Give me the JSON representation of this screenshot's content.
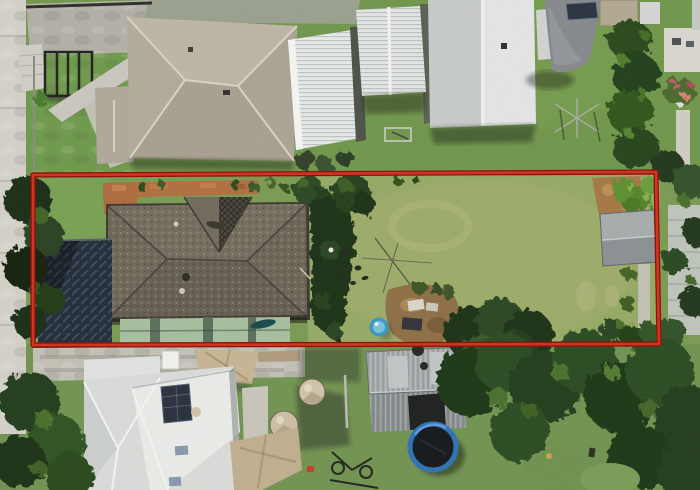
{
  "scene": {
    "kind": "aerial-drone-photograph",
    "subject": "residential lot outlined with red property boundary",
    "boundary": {
      "color_core": "#d03422",
      "color_edge": "#8a140b",
      "points": "33,175 656,172 659,344 33,345"
    }
  },
  "palette": {
    "grass_base": "#7a9a52",
    "grass_top": "#6e9449",
    "backyard_lawn": "#95a965",
    "grass_bottom": "#6f9150",
    "subject_roof": "#6e675b",
    "neighbor_roof_greige": "#b7afa0",
    "neighbor_roof_white": "#e9ebea",
    "veranda_green": "#a7bf9e",
    "carport_shade_navy": "#232c38",
    "concrete": "#c3c0b5",
    "footpath": "#d2d0c7",
    "terracotta": "#b06f3f",
    "dirt_patch": "#a57844",
    "sandpit": "#8e6f46",
    "pool_blue": "#3b97bd",
    "trampoline_ring": "#2f72b4",
    "trampoline_mat": "#15181c",
    "shed_gray": "#9aa0a1",
    "shade_sail_gray": "#85898c",
    "shade_sail_tan": "#c7b493",
    "water_tank": "#cfc3a8",
    "solar_panel": "#28313d",
    "tree_dark": "#1f3718",
    "tree_mid": "#2c4c21",
    "hedge_green": "#2f4f1d"
  },
  "objects": [
    "property-boundary-outline",
    "subject-house-roof",
    "gable-lattice",
    "veranda-roof",
    "carport-shade-cloth",
    "front-lawn",
    "backyard-lawn",
    "sandpit-play-area",
    "kiddie-pool",
    "backyard-shed",
    "corner-shrub",
    "dirt-patch",
    "top-left-house",
    "white-metal-roof",
    "gable-roof-house",
    "gray-shade-sail",
    "clothesline",
    "hedge",
    "footpath",
    "driveway",
    "bottom-house-roof",
    "solar-panel",
    "skylights",
    "water-tanks",
    "tan-shade-sails",
    "trampoline",
    "bicycle",
    "trees"
  ]
}
